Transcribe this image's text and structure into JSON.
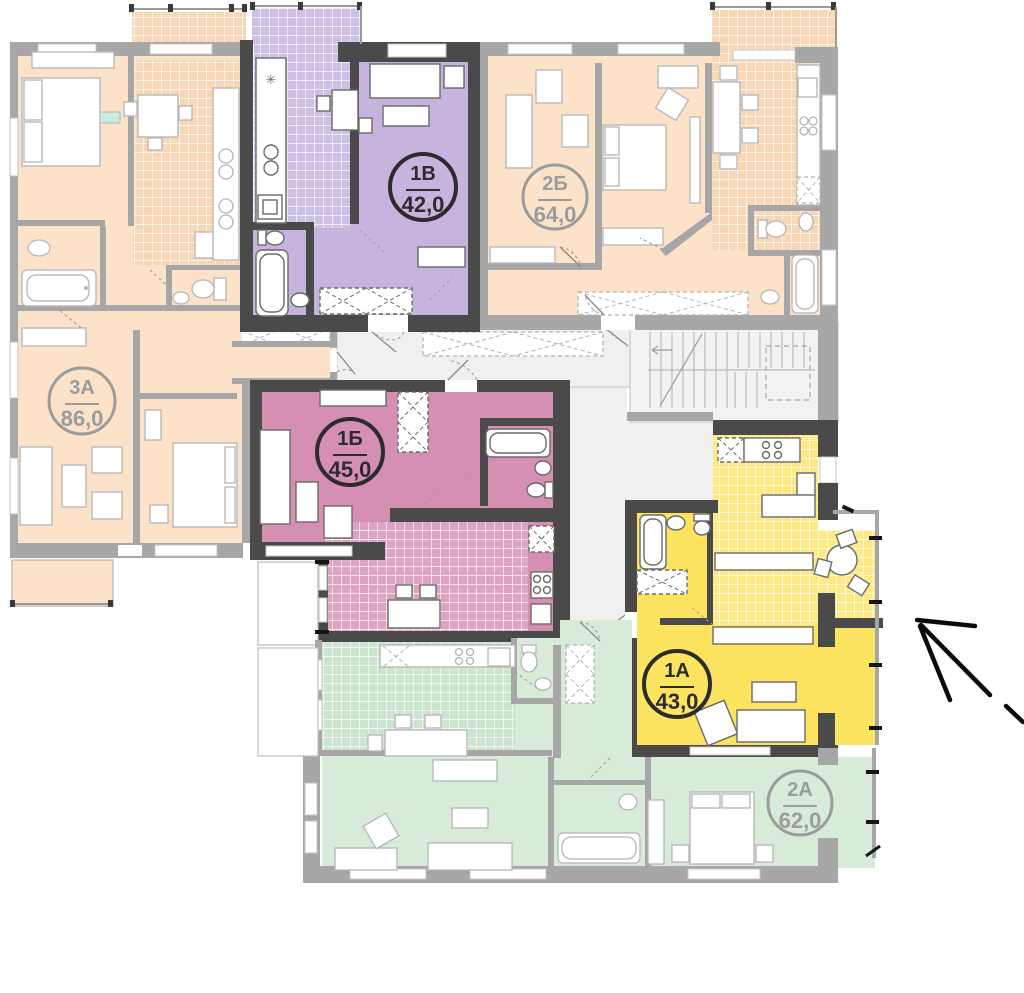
{
  "canvas": {
    "width": 1024,
    "height": 993,
    "background": "#ffffff"
  },
  "plan_type": "residential-floor-plan",
  "apartments": [
    {
      "code": "1В",
      "area": "42,0",
      "highlighted": true,
      "fill": "#c6b4de",
      "tile": "#cdc0e4"
    },
    {
      "code": "2Б",
      "area": "64,0",
      "highlighted": false,
      "fill": "#fbe2c8",
      "tile": "#f8d7b6"
    },
    {
      "code": "3А",
      "area": "86,0",
      "highlighted": false,
      "fill": "#fbe2c8",
      "tile": "#f8d7b6"
    },
    {
      "code": "1Б",
      "area": "45,0",
      "highlighted": true,
      "fill": "#d48fb3",
      "tile": "#dca4c2"
    },
    {
      "code": "1А",
      "area": "43,0",
      "highlighted": true,
      "fill": "#fce460",
      "tile": "#fdea84"
    },
    {
      "code": "2А",
      "area": "62,0",
      "highlighted": false,
      "fill": "#d7ebd8",
      "tile": "#cde5ce"
    }
  ],
  "colors": {
    "peach": "#fbe2c8",
    "peach_tile": "#f8d7b6",
    "purple": "#c6b4de",
    "purple_tile": "#cdc0e4",
    "pink": "#d48fb3",
    "pink_tile": "#dca4c2",
    "yellow": "#fce460",
    "yellow_tile": "#fdea84",
    "green": "#d7ebd8",
    "green_tile": "#cde5ce",
    "wall_dark": "#4a4a4a",
    "wall_gray": "#a7a7a7",
    "corridor": "#f0f0f0",
    "stairs": "#f2f2f2",
    "label_dark": "#2c2c2c",
    "label_gray": "#9c9c9c",
    "arrow": "#0b0b0b"
  },
  "annotations": {
    "pointer_arrow_target": "1А"
  }
}
